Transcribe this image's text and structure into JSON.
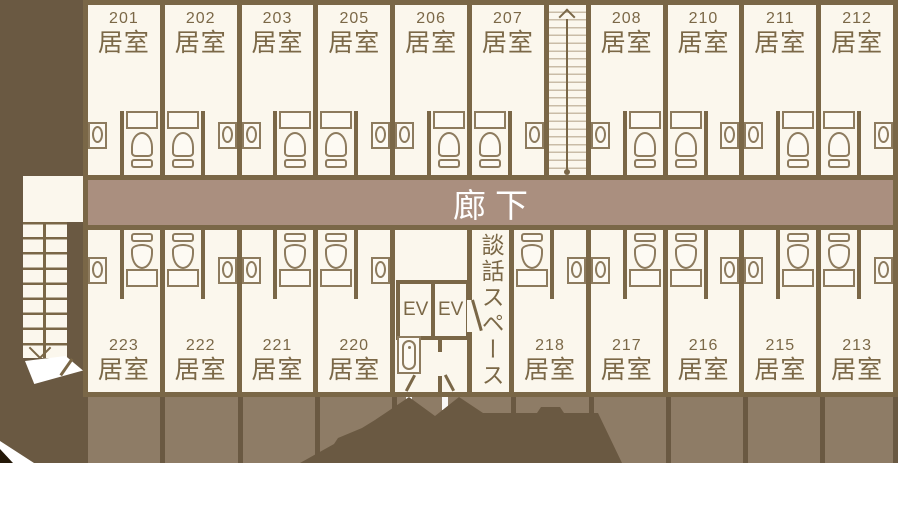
{
  "labels": {
    "corridor": "廊下",
    "talk_space": "談話スペース",
    "elevator": "EV",
    "room_type": "居室"
  },
  "rooms": {
    "top_left": [
      {
        "number": "201",
        "toilet_side": "right"
      },
      {
        "number": "202",
        "toilet_side": "left"
      },
      {
        "number": "203",
        "toilet_side": "right"
      },
      {
        "number": "205",
        "toilet_side": "left"
      },
      {
        "number": "206",
        "toilet_side": "right"
      },
      {
        "number": "207",
        "toilet_side": "left"
      }
    ],
    "top_right": [
      {
        "number": "208",
        "toilet_side": "right"
      },
      {
        "number": "210",
        "toilet_side": "left"
      },
      {
        "number": "211",
        "toilet_side": "right"
      },
      {
        "number": "212",
        "toilet_side": "left"
      }
    ],
    "bottom_left": [
      {
        "number": "223",
        "toilet_side": "right"
      },
      {
        "number": "222",
        "toilet_side": "left"
      },
      {
        "number": "221",
        "toilet_side": "right"
      },
      {
        "number": "220",
        "toilet_side": "left"
      }
    ],
    "bottom_right": [
      {
        "number": "218",
        "toilet_side": "left"
      },
      {
        "number": "217",
        "toilet_side": "right"
      },
      {
        "number": "216",
        "toilet_side": "left"
      },
      {
        "number": "215",
        "toilet_side": "right"
      },
      {
        "number": "213",
        "toilet_side": "left"
      }
    ]
  },
  "colors": {
    "background": "#6A5942",
    "wall": "#7A6747",
    "room_fill": "#FBF7ED",
    "corridor_fill": "#AA8F7F",
    "balcony_fill": "#8E7C66",
    "fixture_outline": "#8D7B5E",
    "label_text": "#7B6847",
    "corridor_text": "#FFFFFF"
  }
}
